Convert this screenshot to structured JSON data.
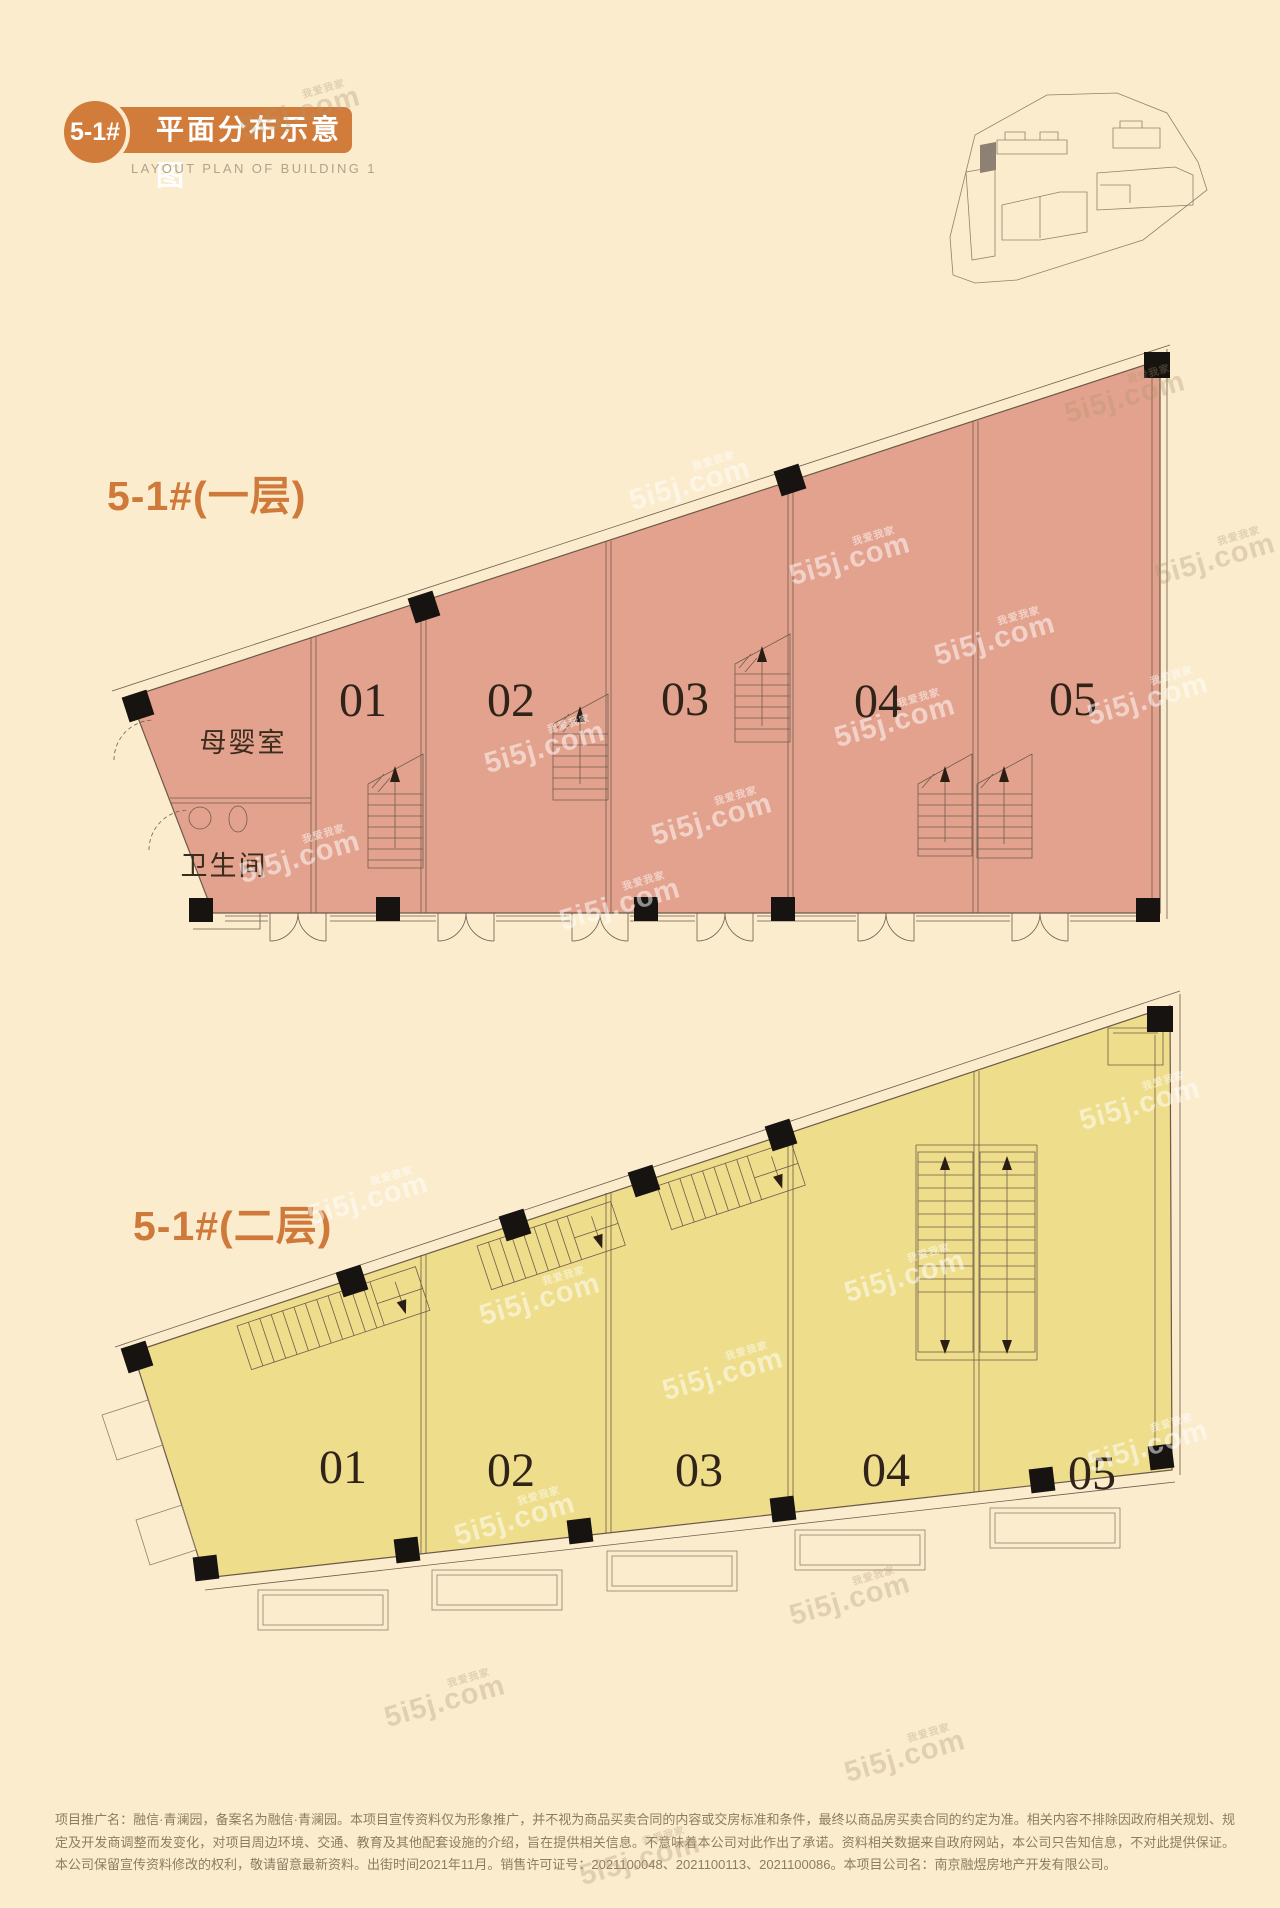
{
  "colors": {
    "accent": "#d27c3c",
    "background": "#fbecce",
    "floor1_fill": "#e3a28d",
    "floor2_fill": "#eedd8a",
    "line": "#6b584a"
  },
  "header": {
    "badge": "5-1#",
    "title": "平面分布示意图",
    "subtitle": "LAYOUT PLAN OF BUILDING 1"
  },
  "floor1": {
    "label": "5-1#(一层)",
    "rooms": {
      "nursing": "母婴室",
      "toilet": "卫生间"
    },
    "units": [
      {
        "label": "01"
      },
      {
        "label": "02"
      },
      {
        "label": "03"
      },
      {
        "label": "04"
      },
      {
        "label": "05"
      }
    ]
  },
  "floor2": {
    "label": "5-1#(二层)",
    "units": [
      {
        "label": "01"
      },
      {
        "label": "02"
      },
      {
        "label": "03"
      },
      {
        "label": "04"
      },
      {
        "label": "05"
      }
    ]
  },
  "watermark": {
    "brand": "5i5j",
    "suffix": ".com",
    "cn": "我爱我家"
  },
  "disclaimer": {
    "lines": [
      "项目推广名：融信·青澜园，备案名为融信·青澜园。本项目宣传资料仅为形象推广，并不视为商品买卖合同的内容或交房标准和条件，最终以商品房买卖合同的约定为准。相关内容不排除因政府相关规划、规定及开发商调整而发变化，对项目周边环境、交通、教育及其他配套设施的介",
      "绍，旨在提供相关信息。不意味着本公司对此作出了承诺。资料相关数据来自政府网站，本公司只告知信息，不对此提供保证。本公司保留宣传资料修改的权利，敬请留意最新资料。出街时间2021年11月。销售许可证号：2021100048、2021100113、2021100086。本项目公司名：南京",
      "融煜房地产开发有限公司。"
    ]
  }
}
